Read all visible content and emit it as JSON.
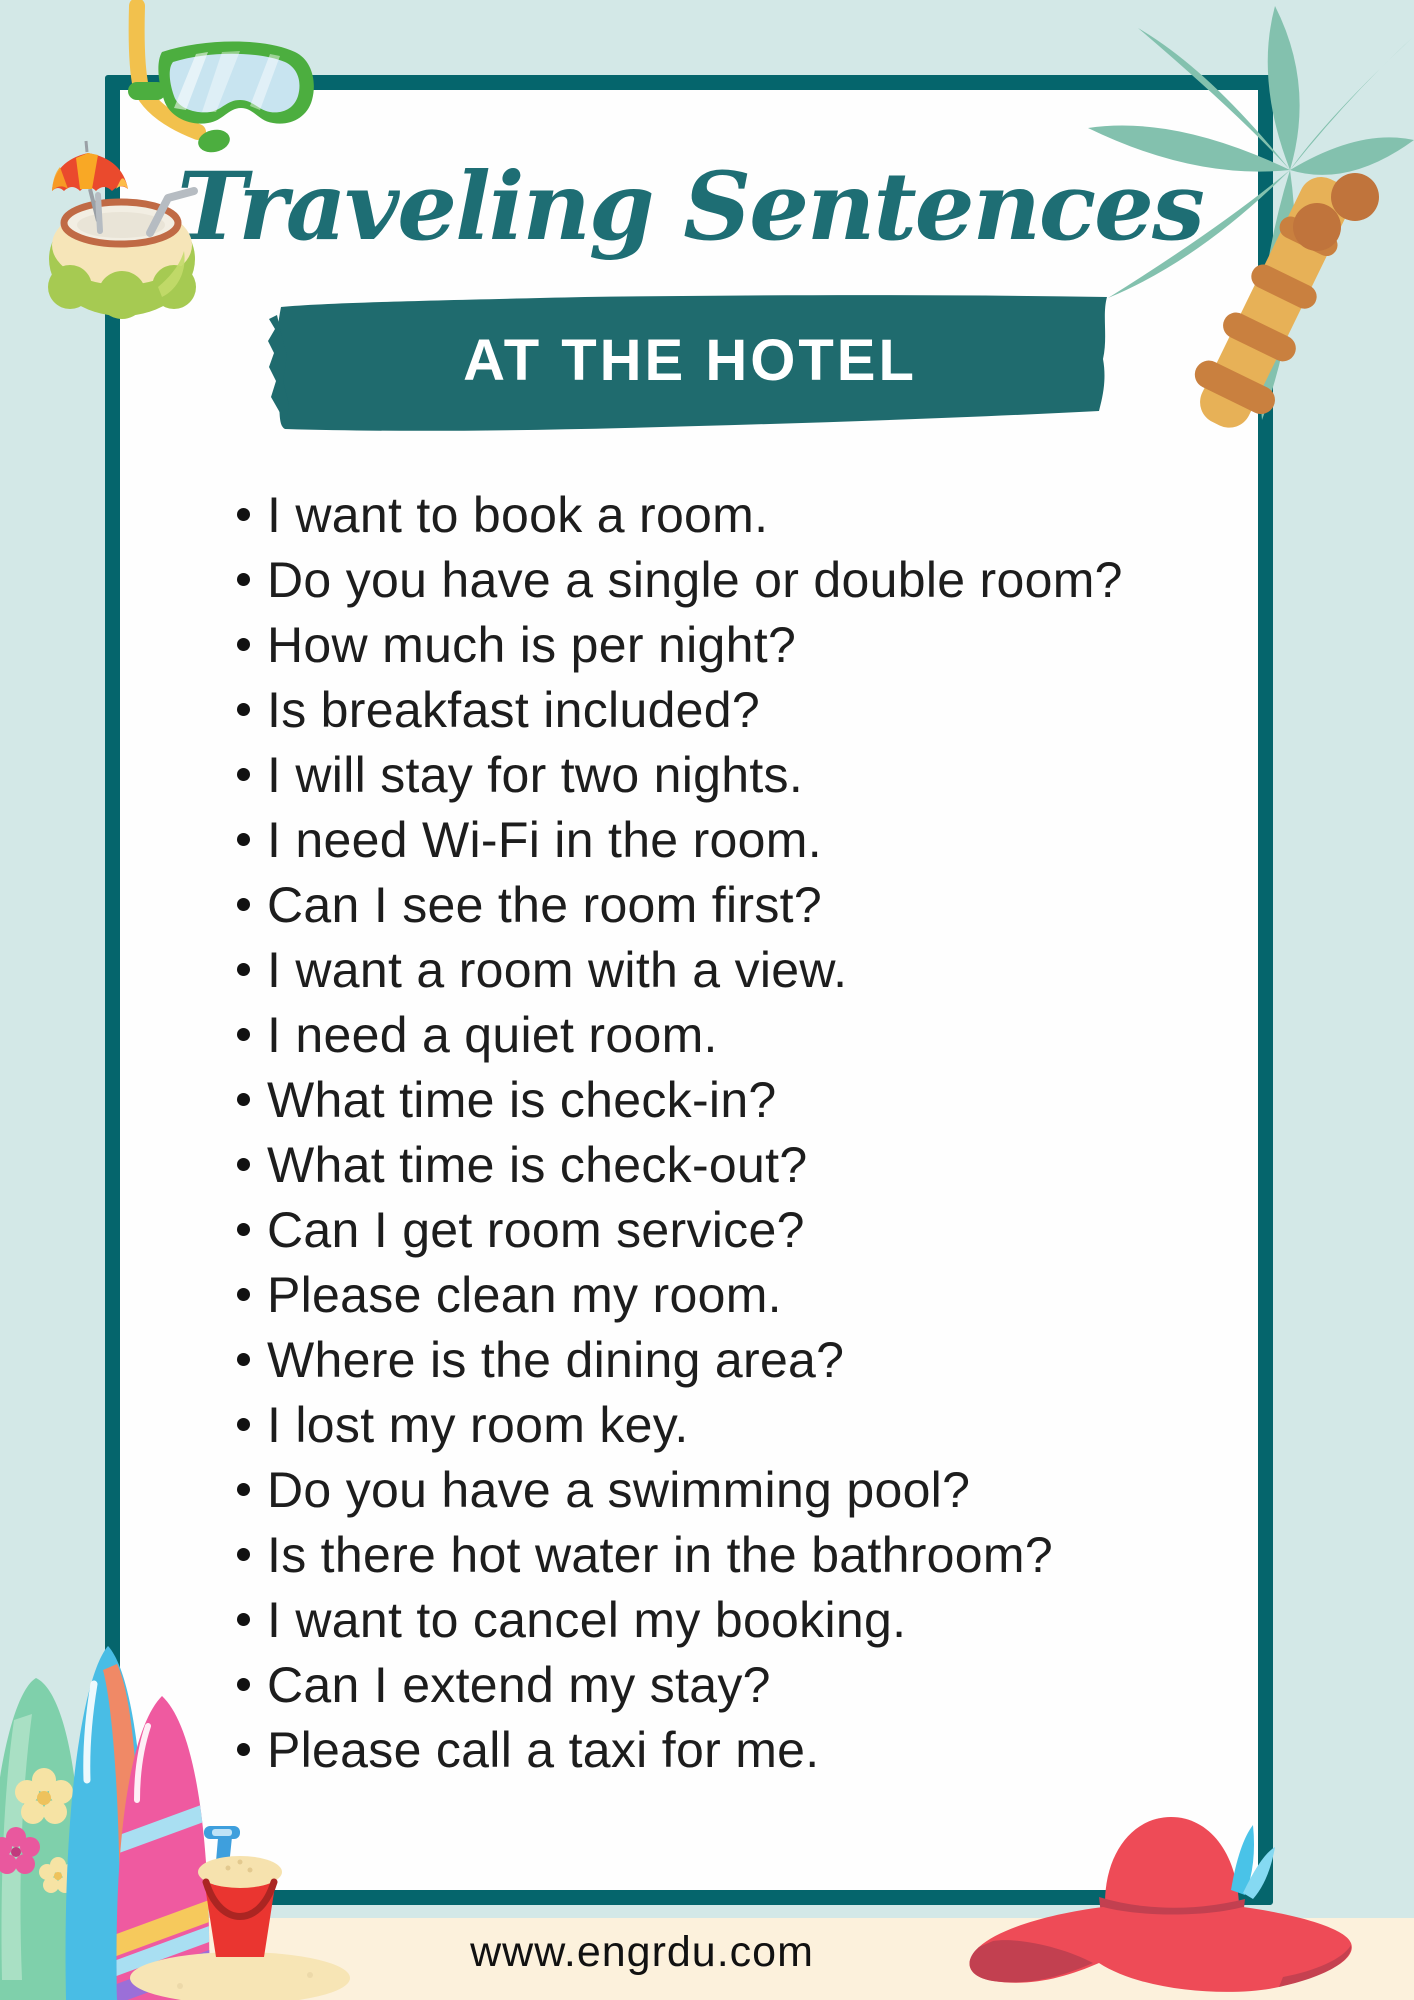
{
  "page": {
    "background_color": "#d3e8e7",
    "sand_strip_color": "#fcf1dc"
  },
  "card": {
    "background_color": "#fefefe",
    "border_color": "#05656c"
  },
  "title": {
    "text": "Traveling Sentences",
    "color": "#1e6e74"
  },
  "banner": {
    "label": "AT THE HOTEL",
    "background_color": "#1f6b6e",
    "text_color": "#ffffff"
  },
  "list": {
    "bullet_color": "#111111",
    "text_color": "#1d1d1d",
    "items": [
      "I want to book a room.",
      "Do you have a single or double room?",
      "How much is per night?",
      "Is breakfast included?",
      "I will stay for two nights.",
      "I need Wi-Fi in the room.",
      "Can I see the room first?",
      "I want a room with a view.",
      "I need a quiet room.",
      "What time is check-in?",
      "What time is check-out?",
      "Can I get room service?",
      "Please clean my room.",
      "Where is the dining area?",
      "I lost my room key.",
      "Do you have a swimming pool?",
      "Is there hot water in the bathroom?",
      "I want to cancel my booking.",
      "Can I extend my stay?",
      "Please call a taxi for me."
    ]
  },
  "footer": {
    "website": "www.engrdu.com",
    "text_color": "#111111"
  },
  "decorations": {
    "top_left": [
      "snorkel-mask",
      "coconut-drink"
    ],
    "top_right": [
      "palm-tree"
    ],
    "bottom_left": [
      "surfboards",
      "sand-bucket"
    ],
    "bottom_right": [
      "beach-hat"
    ],
    "palette": {
      "palm_leaf": "#83c1ae",
      "palm_trunk": "#e7b157",
      "trunk_stripe": "#c9803f",
      "coconut_brown": "#c0743c",
      "mask_green": "#4cae3f",
      "lens_blue": "#c8e4f0",
      "snorkel_yellow": "#f2c14d",
      "drink_green": "#a6ca52",
      "umbrella_red": "#ea4a2d",
      "umbrella_orange": "#f9a825",
      "surf_green": "#7fd0ab",
      "surf_blue": "#49bde5",
      "surf_pink": "#ef5aa0",
      "stripe_lightblue": "#a9dff2",
      "stripe_yellow": "#f6c95c",
      "stripe_purple": "#9b6fd8",
      "bucket_red": "#ea3530",
      "shovel_blue": "#3e9fdd",
      "sand_cream": "#f6e2ae",
      "hat_red": "#ee4b57",
      "hat_band": "#c24050",
      "feather_blue": "#49c3e8"
    }
  }
}
